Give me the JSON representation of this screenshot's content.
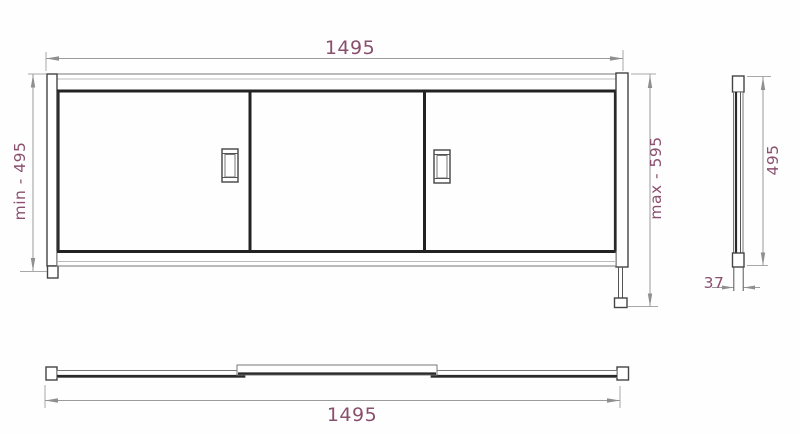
{
  "drawing": {
    "views": {
      "front": {
        "width_label": "1495",
        "height_min_label": "min - 495",
        "height_max_label": "max - 595",
        "door_count": 3,
        "handle_count": 2
      },
      "side": {
        "height_label": "495",
        "thickness_label": "37"
      },
      "bottom": {
        "width_label": "1495"
      }
    },
    "colors": {
      "background": "#fefefe",
      "drawing_line_dark": "#222222",
      "drawing_line_medium": "#555555",
      "dimension_line": "#9b9b9b",
      "dimension_text": "#8a4f6e"
    }
  }
}
